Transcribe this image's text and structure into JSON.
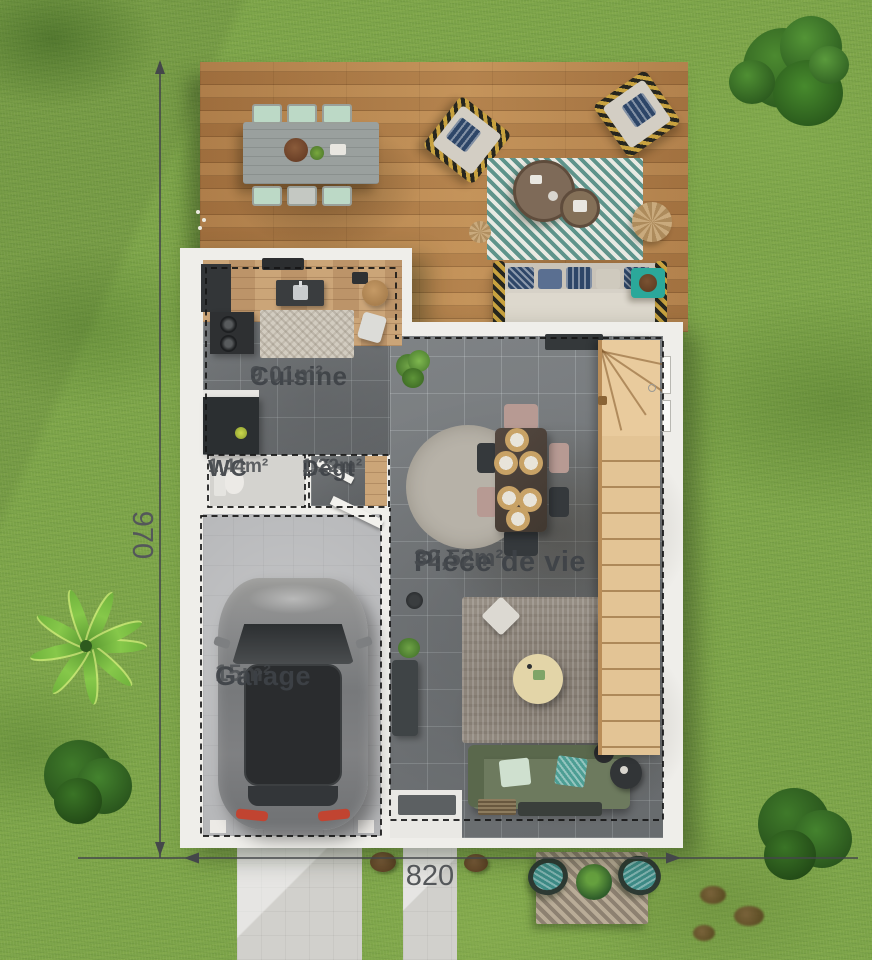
{
  "plan_title": "floor-plan-render",
  "rooms": [
    {
      "name": "Cuisine",
      "area": "9.01m²"
    },
    {
      "name": "WC",
      "area": "1,44m²"
    },
    {
      "name": "Dégt",
      "area": "1,22m²"
    },
    {
      "name": "Pièce de vie",
      "area": "32,52m²"
    },
    {
      "name": "Garage",
      "area": "15m²"
    }
  ],
  "dimensions": {
    "height": "970",
    "width": "820"
  },
  "colors": {
    "grass": "#7ba348",
    "deck_wood": "#b5834d",
    "wall": "#efeeea",
    "tile_floor": "#75797c",
    "garage_floor": "#b6b7b9",
    "stairs_wood": "#e3c495",
    "sofa_olive": "#6d7a5e",
    "accent_teal": "#2ba89a",
    "label_text": "#3e4247",
    "dimension_text": "#54575a"
  }
}
